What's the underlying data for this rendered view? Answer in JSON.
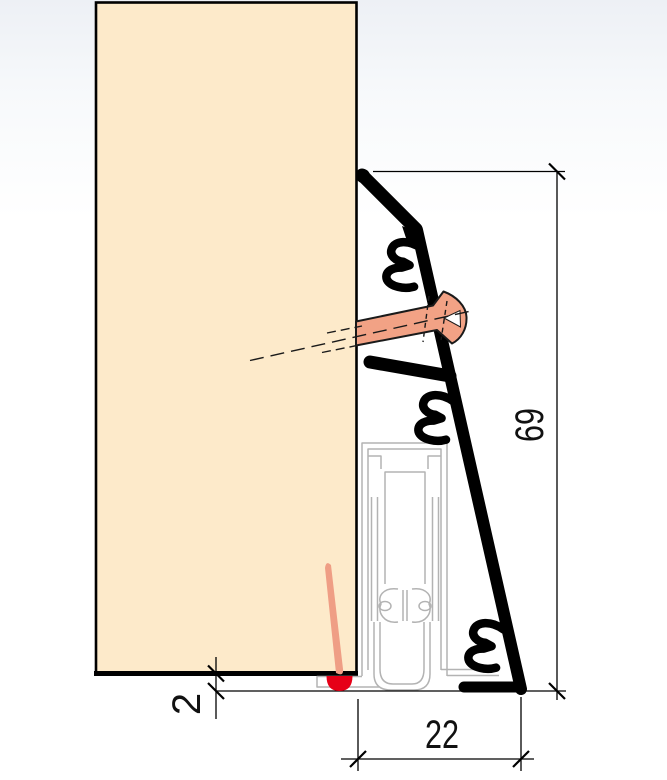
{
  "drawing": {
    "title": "skirting-profile-cross-section",
    "dimensions": {
      "height_mm": "69",
      "width_mm": "22",
      "gap_mm": "2"
    },
    "colors": {
      "wall_fill": "#fdeaca",
      "outline": "#000000",
      "screw_fill": "#f2a285",
      "sealant_fill": "#ef9e85",
      "drop_fill": "#e60017",
      "seal_profile_stroke": "#b3b3b3",
      "dimension_line": "#000000",
      "background_top": "#edf0f5",
      "background": "#ffffff"
    }
  }
}
